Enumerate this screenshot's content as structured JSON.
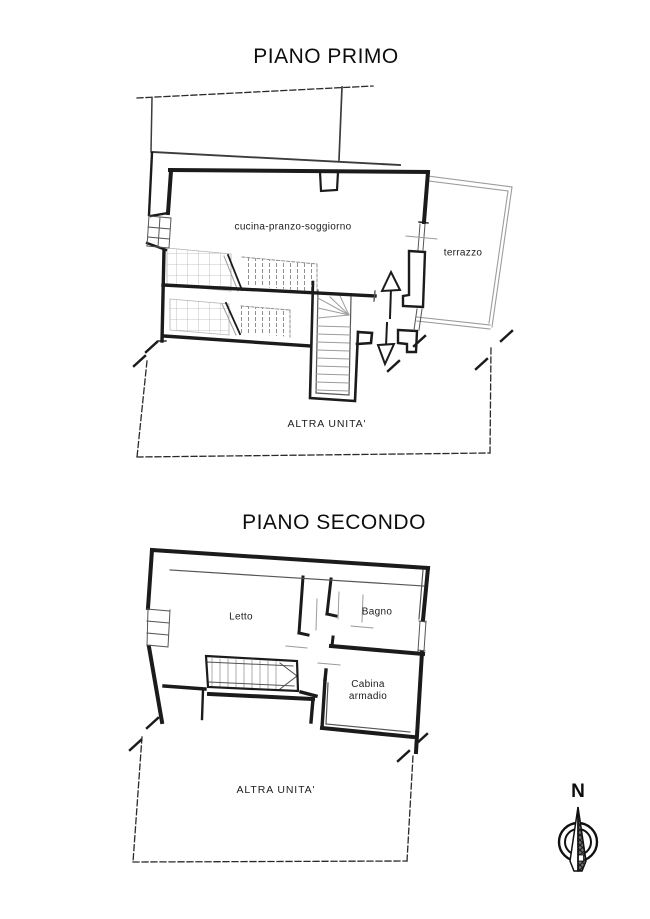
{
  "plans": [
    {
      "title": "PIANO PRIMO",
      "labels": {
        "kitchen_living": "cucina-pranzo-soggiorno",
        "terrace": "terrazzo",
        "other_unit": "ALTRA UNITA'"
      }
    },
    {
      "title": "PIANO SECONDO",
      "labels": {
        "bedroom": "Letto",
        "bathroom": "Bagno",
        "walk_in_closet": "Cabina armadio",
        "other_unit": "ALTRA UNITA'"
      }
    }
  ],
  "compass": {
    "north": "N"
  },
  "colors": {
    "wall": "#1b1b1b",
    "thin_gray": "#9c9c9c",
    "medium": "#555555",
    "dashed_boundary": "#2a2a2a",
    "background": "#ffffff"
  }
}
